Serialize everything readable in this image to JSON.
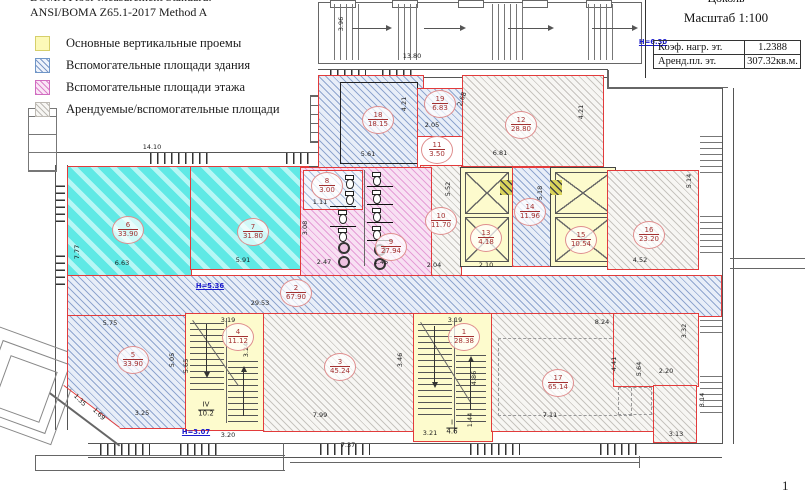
{
  "header": {
    "line1": "BOMA Floor Measurement Standard:",
    "line2": "ANSI/BOMA Z65.1-2017 Method A"
  },
  "legend": {
    "items": [
      {
        "swatch": "yellow",
        "label": "Основные вертикальные проемы"
      },
      {
        "swatch": "blue",
        "label": "Вспомогательные площади здания"
      },
      {
        "swatch": "pink",
        "label": "Вспомогательные площади этажа"
      },
      {
        "swatch": "gray",
        "label": "Арендуемые/вспомогательные площади"
      }
    ]
  },
  "title_block": {
    "floor_label": "Цоколь",
    "scale_label": "Масштаб 1:100",
    "rows": [
      {
        "label": "Коэф. нагр. эт.",
        "value": "1.2388"
      },
      {
        "label": "Аренд.пл. эт.",
        "value": "307.32кв.м."
      }
    ]
  },
  "page_number": "1",
  "colors": {
    "boundary_red": "#e23b3b",
    "hatch_blue": "#6080b9",
    "hatch_cyan": "#5fe9e5",
    "hatch_pink": "#d668c0",
    "hatch_gray": "#8c8780",
    "vertical_opening_yellow": "#fdfbcd",
    "height_mark_blue": "#1a1acc"
  },
  "plan": {
    "rooms": [
      {
        "num": "6",
        "area": "33.90",
        "x": 128,
        "y": 230
      },
      {
        "num": "7",
        "area": "31.80",
        "x": 253,
        "y": 232
      },
      {
        "num": "18",
        "area": "18.15",
        "x": 378,
        "y": 120
      },
      {
        "num": "19",
        "area": "6.83",
        "x": 440,
        "y": 104
      },
      {
        "num": "11",
        "area": "3.50",
        "x": 437,
        "y": 150
      },
      {
        "num": "12",
        "area": "28.80",
        "x": 521,
        "y": 125
      },
      {
        "num": "16",
        "area": "23.20",
        "x": 649,
        "y": 235
      },
      {
        "num": "10",
        "area": "11.70",
        "x": 441,
        "y": 221
      },
      {
        "num": "13",
        "area": "4.18",
        "x": 486,
        "y": 238
      },
      {
        "num": "14",
        "area": "11.96",
        "x": 530,
        "y": 212
      },
      {
        "num": "15",
        "area": "10.54",
        "x": 581,
        "y": 240
      },
      {
        "num": "8",
        "area": "3.00",
        "x": 327,
        "y": 186
      },
      {
        "num": "9",
        "area": "27.94",
        "x": 391,
        "y": 247
      },
      {
        "num": "2",
        "area": "67.90",
        "x": 296,
        "y": 293
      },
      {
        "num": "5",
        "area": "33.90",
        "x": 133,
        "y": 360
      },
      {
        "num": "4",
        "area": "11.12",
        "x": 238,
        "y": 337
      },
      {
        "num": "3",
        "area": "45.24",
        "x": 340,
        "y": 367
      },
      {
        "num": "1",
        "area": "28.38",
        "x": 464,
        "y": 337
      },
      {
        "num": "17",
        "area": "65.14",
        "x": 558,
        "y": 383
      }
    ],
    "stairs": [
      {
        "num": "IV",
        "area": "10.2",
        "x": 206,
        "y": 410
      },
      {
        "num": "I",
        "area": "4.6",
        "x": 452,
        "y": 428
      }
    ],
    "height_marks": [
      {
        "text": "Н=6.30",
        "x": 653,
        "y": 42
      },
      {
        "text": "Н=5.36",
        "x": 210,
        "y": 286
      },
      {
        "text": "Н=3.07",
        "x": 196,
        "y": 432
      }
    ],
    "dims": [
      {
        "t": "14.10",
        "x": 152,
        "y": 147
      },
      {
        "t": "3.96",
        "x": 341,
        "y": 24,
        "rot": -90
      },
      {
        "t": "13.80",
        "x": 412,
        "y": 56
      },
      {
        "t": "6.63",
        "x": 122,
        "y": 263
      },
      {
        "t": "5.91",
        "x": 243,
        "y": 260
      },
      {
        "t": "7.77",
        "x": 77,
        "y": 252,
        "rot": -90
      },
      {
        "t": "5.61",
        "x": 368,
        "y": 154
      },
      {
        "t": "4.21",
        "x": 404,
        "y": 104,
        "rot": -90
      },
      {
        "t": "2.05",
        "x": 432,
        "y": 125
      },
      {
        "t": "2.68",
        "x": 462,
        "y": 99,
        "rot": -70
      },
      {
        "t": "6.81",
        "x": 500,
        "y": 153
      },
      {
        "t": "4.21",
        "x": 581,
        "y": 112,
        "rot": -90
      },
      {
        "t": "5.52",
        "x": 448,
        "y": 189,
        "rot": -90
      },
      {
        "t": "5.18",
        "x": 540,
        "y": 193,
        "rot": -90
      },
      {
        "t": "2.04",
        "x": 434,
        "y": 265
      },
      {
        "t": "2.10",
        "x": 486,
        "y": 265
      },
      {
        "t": "1.11",
        "x": 320,
        "y": 202
      },
      {
        "t": "3.08",
        "x": 305,
        "y": 228,
        "rot": -90
      },
      {
        "t": "2.47",
        "x": 324,
        "y": 262
      },
      {
        "t": "1.45",
        "x": 381,
        "y": 262
      },
      {
        "t": "5.14",
        "x": 689,
        "y": 181,
        "rot": -90
      },
      {
        "t": "4.52",
        "x": 640,
        "y": 260
      },
      {
        "t": "29.53",
        "x": 260,
        "y": 303
      },
      {
        "t": "5.75",
        "x": 110,
        "y": 323
      },
      {
        "t": "3.25",
        "x": 142,
        "y": 413
      },
      {
        "t": "5.65",
        "x": 186,
        "y": 366,
        "rot": -90
      },
      {
        "t": "5.05",
        "x": 172,
        "y": 360,
        "rot": -90
      },
      {
        "t": "1.35",
        "x": 80,
        "y": 400,
        "rot": 45
      },
      {
        "t": "1.69",
        "x": 99,
        "y": 414,
        "rot": 45
      },
      {
        "t": "3.19",
        "x": 228,
        "y": 320
      },
      {
        "t": "3.24",
        "x": 246,
        "y": 350,
        "rot": -90
      },
      {
        "t": "3.20",
        "x": 228,
        "y": 435
      },
      {
        "t": "7.99",
        "x": 320,
        "y": 415
      },
      {
        "t": "7.37",
        "x": 348,
        "y": 445
      },
      {
        "t": "3.46",
        "x": 400,
        "y": 360,
        "rot": -90
      },
      {
        "t": "3.19",
        "x": 455,
        "y": 320
      },
      {
        "t": "4.86",
        "x": 474,
        "y": 378,
        "rot": -90
      },
      {
        "t": "1.44",
        "x": 470,
        "y": 420,
        "rot": -90
      },
      {
        "t": "3.21",
        "x": 430,
        "y": 433
      },
      {
        "t": "8.24",
        "x": 602,
        "y": 322
      },
      {
        "t": "4.41",
        "x": 614,
        "y": 364,
        "rot": -90
      },
      {
        "t": "7.11",
        "x": 550,
        "y": 415
      },
      {
        "t": "5.64",
        "x": 639,
        "y": 369,
        "rot": -90
      },
      {
        "t": "2.20",
        "x": 666,
        "y": 371
      },
      {
        "t": "3.32",
        "x": 684,
        "y": 331,
        "rot": -90
      },
      {
        "t": "3.14",
        "x": 702,
        "y": 400,
        "rot": -90
      },
      {
        "t": "3.13",
        "x": 676,
        "y": 434
      }
    ]
  }
}
